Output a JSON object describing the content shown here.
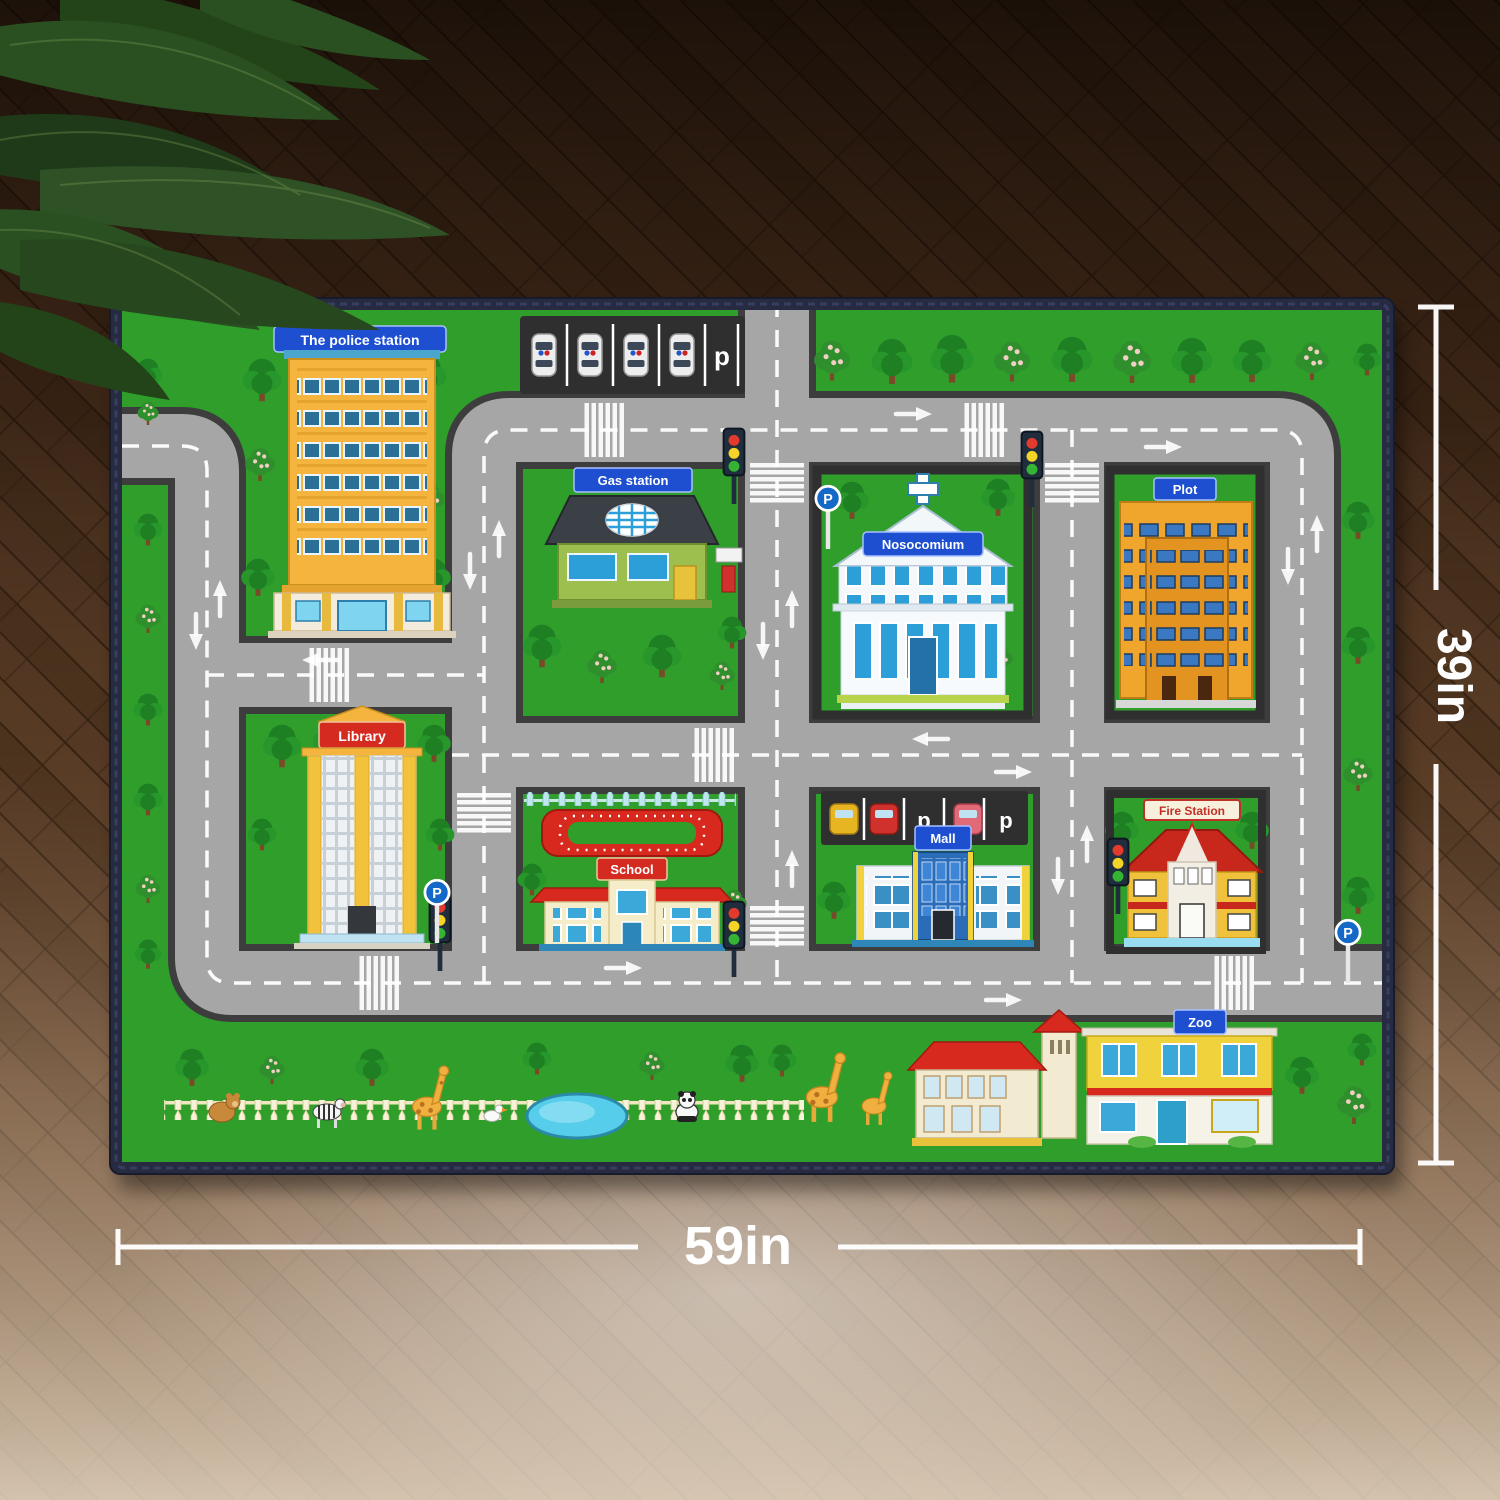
{
  "product_photo": {
    "floor": {
      "wood_color": "#4e331e",
      "plank_seam": "#2c1a0c",
      "style": "herringbone wood, dark at top fading to pale at bottom"
    },
    "plant": {
      "leaf_color": "#2a4f21",
      "position": "top-left corner"
    },
    "dimensions": {
      "height_label": "39in",
      "width_label": "59in",
      "line_color": "#ffffff"
    }
  },
  "rug": {
    "border_color": "#262b41",
    "grass_color": "#2f9e2b",
    "road_color": "#a6a6a6",
    "road_edge_color": "#3d3d3d",
    "marking_color": "#ffffff",
    "signs": {
      "police_station": "The police station",
      "gas_station": "Gas station",
      "hospital": "Nosocomium",
      "plot": "Plot",
      "library": "Library",
      "school": "School",
      "mall": "Mall",
      "fire_station": "Fire Station",
      "zoo": "Zoo"
    },
    "parking": {
      "lot_letter": "p",
      "sign_letter": "P"
    },
    "building_colors": {
      "police": "#f4b43e",
      "gas": "#9cbf4e",
      "hospital": "#f7fafc",
      "plot": "#f0a52c",
      "library": "#f2c23c",
      "school": "#f5ecca",
      "mall": "#2b6cb8",
      "fire": "#f0c23c",
      "zoo": "#f0d23c",
      "sign_blue": "#1d4fd0",
      "sign_red": "#d52a20",
      "track_red": "#d8291e"
    },
    "zoo_animals": [
      "bear",
      "zebra",
      "giraffe",
      "duck",
      "panda",
      "pond"
    ]
  }
}
